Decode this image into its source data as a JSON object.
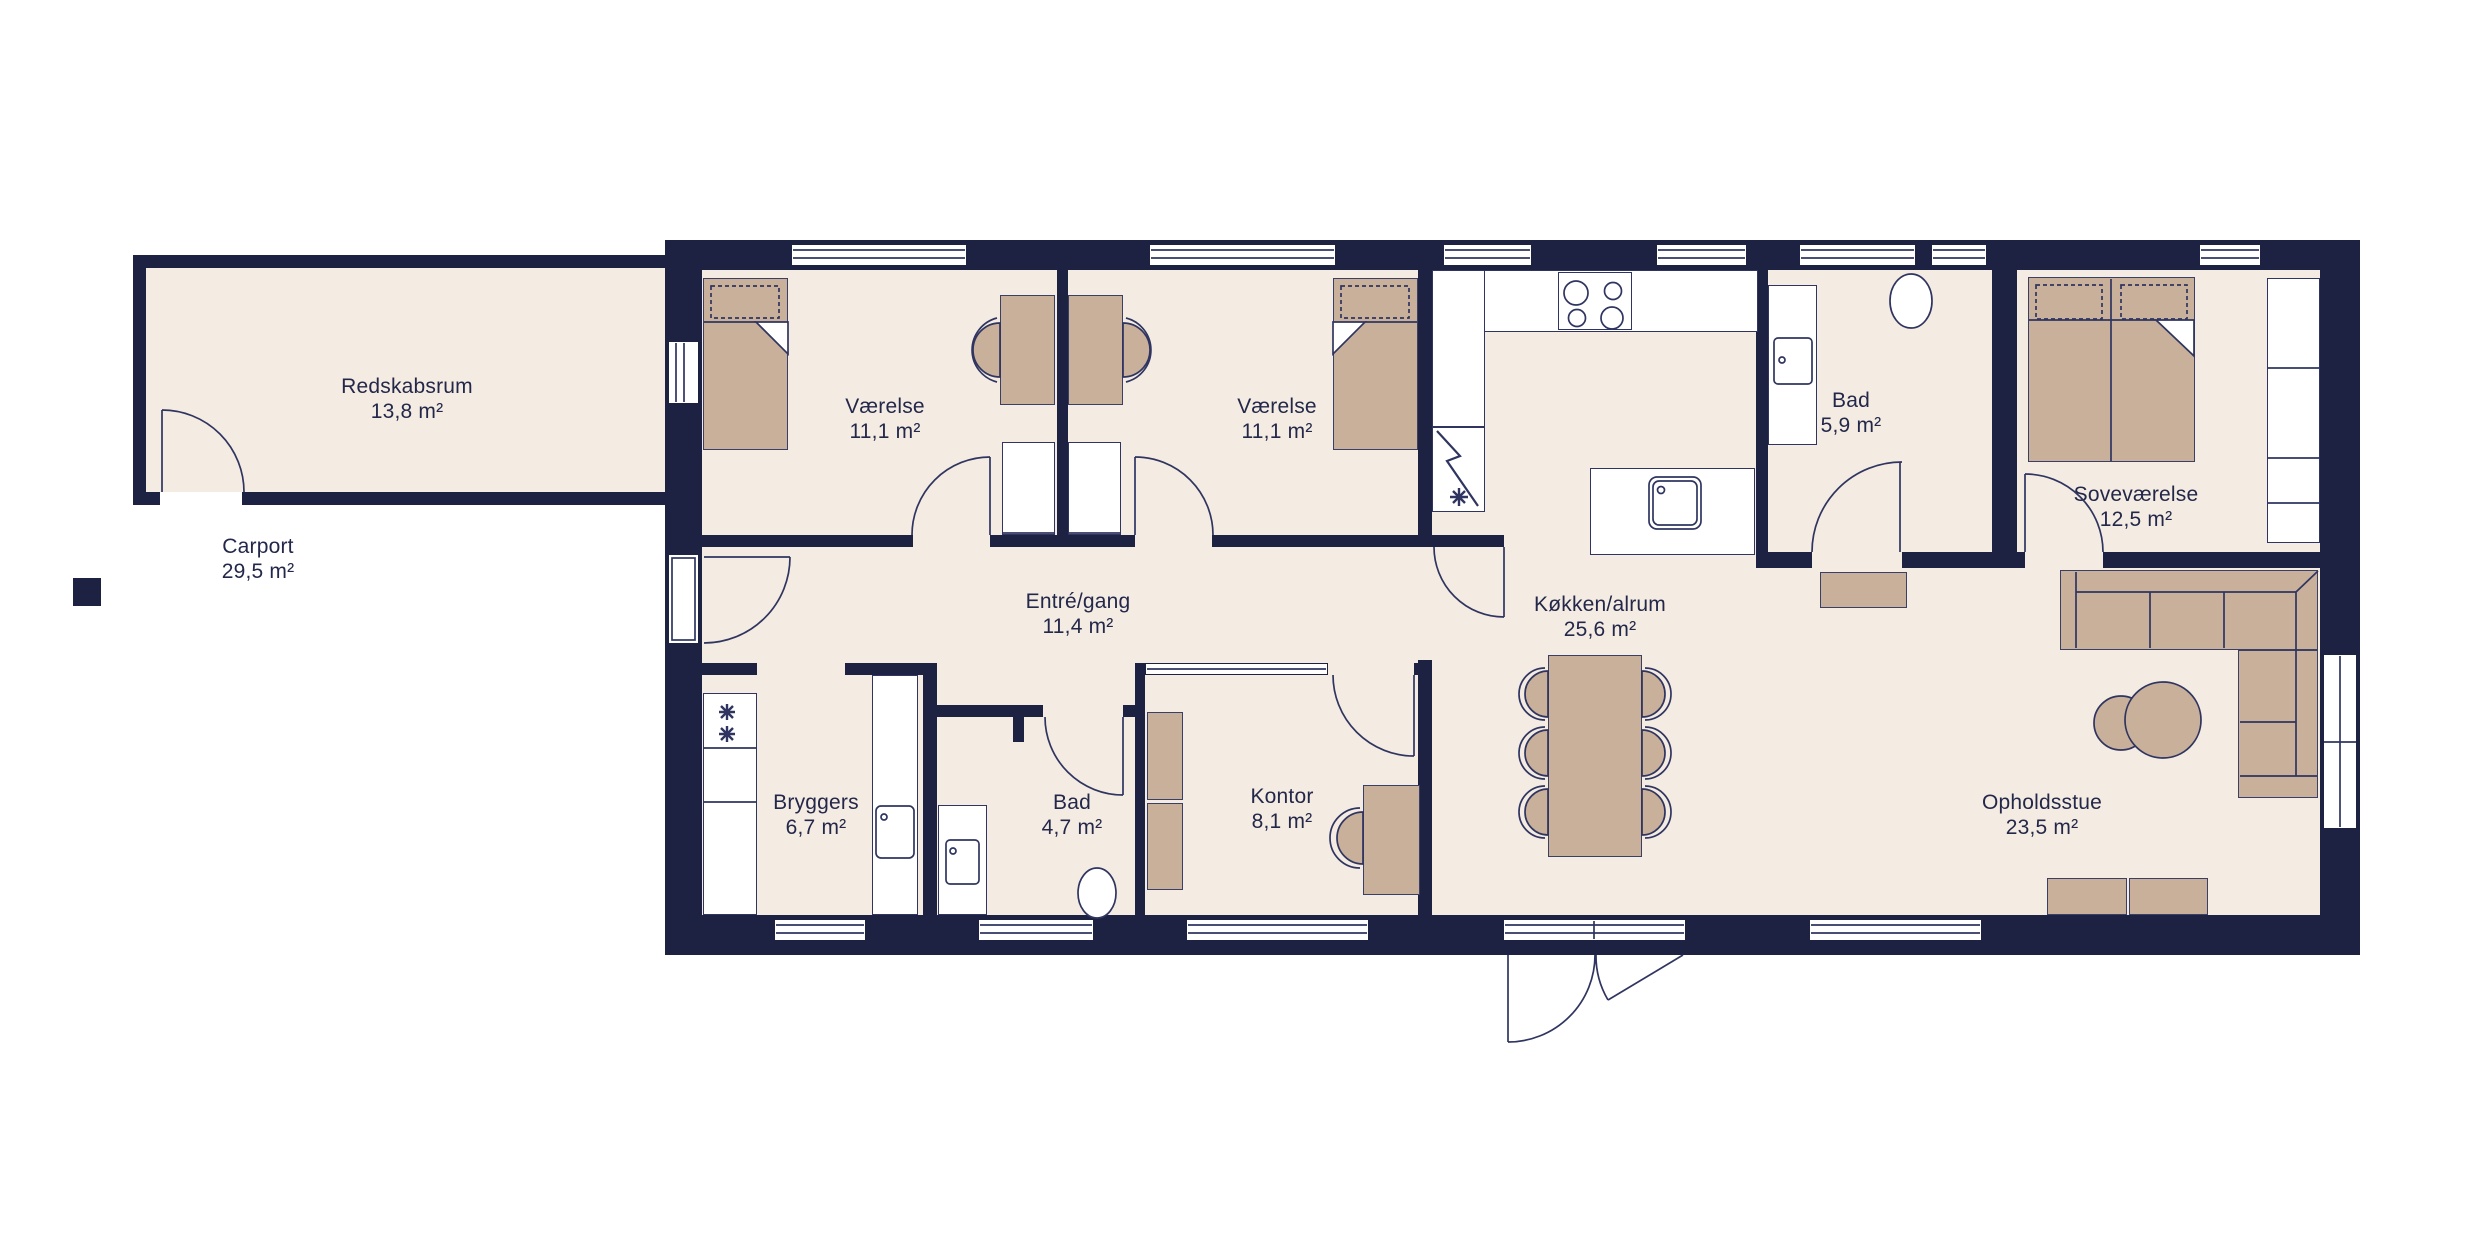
{
  "colors": {
    "wall": "#1d2242",
    "floor": "#f4ebe2",
    "furniture": "#c9b09a",
    "outline": "#2f3560",
    "text": "#23284a",
    "white": "#ffffff"
  },
  "rooms": [
    {
      "id": "redskabsrum",
      "name": "Redskabsrum",
      "area": "13,8 m²"
    },
    {
      "id": "carport",
      "name": "Carport",
      "area": "29,5 m²"
    },
    {
      "id": "vaerelse-1",
      "name": "Værelse",
      "area": "11,1 m²"
    },
    {
      "id": "vaerelse-2",
      "name": "Værelse",
      "area": "11,1 m²"
    },
    {
      "id": "entre-gang",
      "name": "Entré/gang",
      "area": "11,4 m²"
    },
    {
      "id": "bryggers",
      "name": "Bryggers",
      "area": "6,7 m²"
    },
    {
      "id": "bad-lille",
      "name": "Bad",
      "area": "4,7 m²"
    },
    {
      "id": "kontor",
      "name": "Kontor",
      "area": "8,1 m²"
    },
    {
      "id": "koekken-alrum",
      "name": "Køkken/alrum",
      "area": "25,6 m²"
    },
    {
      "id": "bad-stor",
      "name": "Bad",
      "area": "5,9 m²"
    },
    {
      "id": "sovevaerelse",
      "name": "Soveværelse",
      "area": "12,5 m²"
    },
    {
      "id": "opholdsstue",
      "name": "Opholdsstue",
      "area": "23,5 m²"
    }
  ]
}
